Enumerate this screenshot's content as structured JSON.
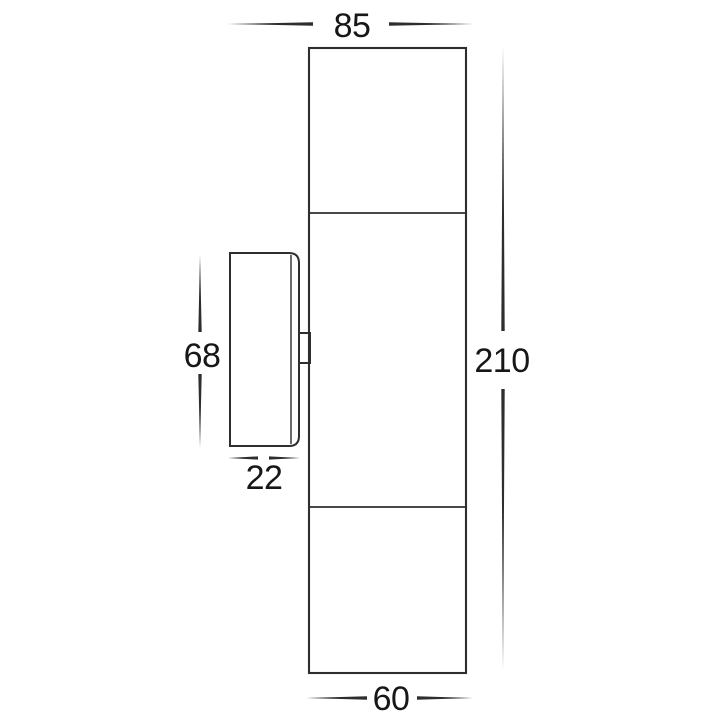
{
  "drawing": {
    "title": "wall-light-dimension-diagram",
    "dimensions": {
      "overall_depth_top": "85",
      "overall_height_right": "210",
      "bracket_height_left": "68",
      "bracket_depth_left": "22",
      "body_width_bottom": "60"
    },
    "colors": {
      "line": "#2e2e2e",
      "text": "#171717",
      "background": "#ffffff"
    }
  }
}
